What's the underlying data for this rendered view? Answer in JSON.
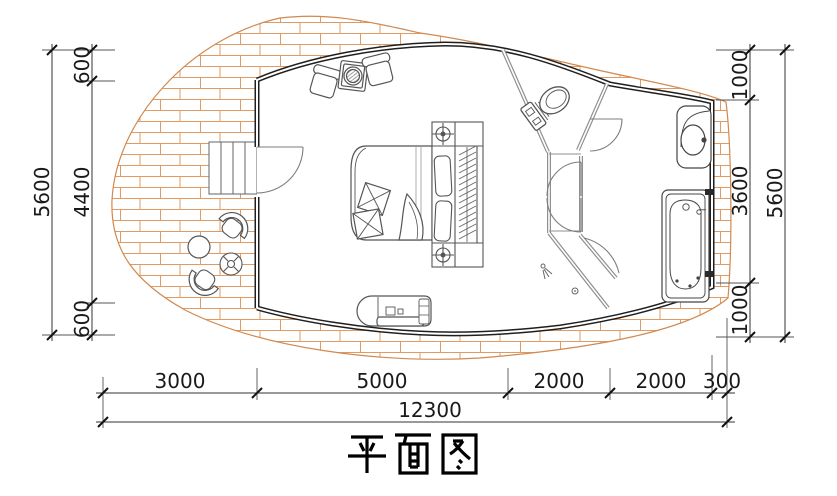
{
  "title": "平面图",
  "dims": {
    "left": {
      "segments": [
        "600",
        "4400",
        "600"
      ],
      "total": "5600"
    },
    "right": {
      "segments": [
        "1000",
        "3600",
        "1000"
      ],
      "total": "5600"
    },
    "bottom": {
      "segments": [
        "3000",
        "5000",
        "2000",
        "2000",
        "300"
      ],
      "total": "12300"
    }
  },
  "colors": {
    "brick_hatch": "#e29a63",
    "deck_outline": "#d08950",
    "wall": "#1f1f1f",
    "partition": "#8f8f8f",
    "dimension": "#1a1a1a",
    "background": "#ffffff"
  }
}
